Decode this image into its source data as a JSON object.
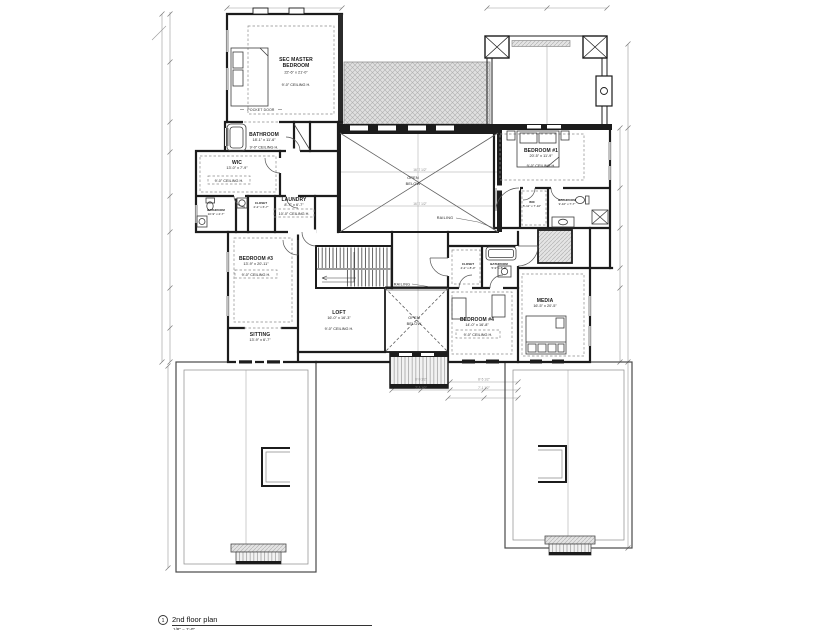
{
  "colors": {
    "wall": "#1c1c1c",
    "hatch_fill": "#e4e4e4",
    "hatch_line": "#b5b5b5",
    "dim_line": "#9a9a9a"
  },
  "title_block": {
    "sheet_number": "1",
    "title": "2nd floor plan",
    "scale": "1/8\" = 1'-0\""
  },
  "annotations": {
    "pocket_door": "POCKET DOOR",
    "open": "OPEN",
    "below": "BELOW",
    "railing": "RAILING"
  },
  "dim_labels": [
    "16'-7 1/2\"",
    "16'-7 1/2\"",
    "8'-9 1/2\"",
    "8'-5 1/2\"",
    "7'-3 1/2\"",
    "7'-1 1/2\""
  ],
  "rooms": {
    "sec_master_bedroom": {
      "name1": "SEC MASTER",
      "name2": "BEDROOM",
      "dims": "22'-6\" x 21'-0\"",
      "ceiling": "9'-0\" CEILING H."
    },
    "master_bathroom": {
      "name": "BATHROOM",
      "dims": "18'-1\" x 11'-6\"",
      "ceiling": "9'-0\" CEILING H."
    },
    "master_wic": {
      "name": "WIC",
      "dims": "13'-0\" x 7'-9\"",
      "ceiling": "9'-0\" CEILING H."
    },
    "hall_bathroom": {
      "name": "BATHROOM",
      "dims": "10'-9\" x 4'-7\""
    },
    "hall_closet": {
      "name": "CLOSET",
      "dims": "2'-2\" x 6'-7\""
    },
    "laundry": {
      "name": "LAUNDRY",
      "dims": "8'-7\" x 6'-7\"",
      "ceiling": "10'-0\" CEILING H."
    },
    "bedroom_1": {
      "name": "BEDROOM #1",
      "dims": "20'-5\" x 11'-9\"",
      "ceiling": "9'-0\" CEILING H."
    },
    "bedroom_1_wic": {
      "name": "WIC",
      "dims": "5'-11\" x 7'-10\""
    },
    "bedroom_1_bathroom": {
      "name": "BATHROOM",
      "dims": "9'-10\" x 7'-7\""
    },
    "bedroom_3": {
      "name": "BEDROOM #3",
      "dims": "13'-9\" x 20'-11\"",
      "ceiling": "9'-0\" CEILING H."
    },
    "sitting": {
      "name": "SITTING",
      "dims": "13'-9\" x 6'-7\""
    },
    "loft": {
      "name": "LOFT",
      "dims": "16'-0\" x 16'-3\"",
      "ceiling": "9'-0\" CEILING H."
    },
    "bedroom_4": {
      "name": "BEDROOM #4",
      "dims": "14'-0\" x 16'-8\"",
      "ceiling": "9'-0\" CEILING H."
    },
    "bedroom_4_closet": {
      "name": "CLOSET",
      "dims": "4'-2\" x 8'-0\""
    },
    "bedroom_4_bathroom": {
      "name": "BATHROOM",
      "dims": "5'-9\" x 8'-9\""
    },
    "media": {
      "name": "MEDIA",
      "dims": "16'-5\" x 20'-5\""
    }
  }
}
